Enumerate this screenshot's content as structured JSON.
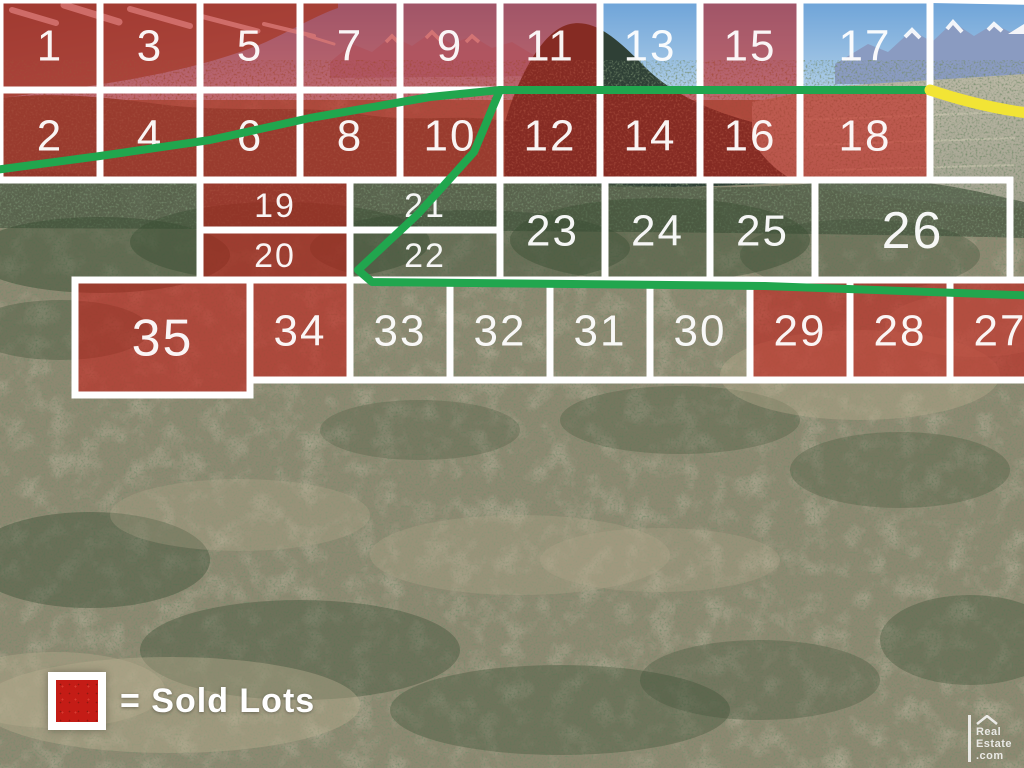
{
  "legend": {
    "label": "= Sold Lots",
    "swatch_meaning": "sold lot"
  },
  "logo": {
    "lines": [
      "Real",
      "Estate",
      ".com"
    ],
    "icon": "roof-icon"
  },
  "colors": {
    "sold_fill": "#c41c16",
    "boundary_white": "#ffffff",
    "trail_green": "#21a64e",
    "boundary_yellow": "#f2e435"
  },
  "plat": {
    "lots": [
      {
        "num": 1,
        "sold": true,
        "x": 0,
        "y": 0,
        "w": 100,
        "h": 90
      },
      {
        "num": 3,
        "sold": true,
        "x": 100,
        "y": 0,
        "w": 100,
        "h": 90
      },
      {
        "num": 5,
        "sold": true,
        "x": 200,
        "y": 0,
        "w": 100,
        "h": 90
      },
      {
        "num": 7,
        "sold": true,
        "x": 300,
        "y": 0,
        "w": 100,
        "h": 90
      },
      {
        "num": 9,
        "sold": true,
        "x": 400,
        "y": 0,
        "w": 100,
        "h": 90
      },
      {
        "num": 11,
        "sold": true,
        "x": 500,
        "y": 0,
        "w": 100,
        "h": 90
      },
      {
        "num": 13,
        "sold": false,
        "x": 600,
        "y": 0,
        "w": 100,
        "h": 90
      },
      {
        "num": 15,
        "sold": true,
        "x": 700,
        "y": 0,
        "w": 100,
        "h": 90
      },
      {
        "num": 17,
        "sold": false,
        "x": 800,
        "y": 0,
        "w": 130,
        "h": 90
      },
      {
        "num": 2,
        "sold": true,
        "x": 0,
        "y": 90,
        "w": 100,
        "h": 90
      },
      {
        "num": 4,
        "sold": true,
        "x": 100,
        "y": 90,
        "w": 100,
        "h": 90
      },
      {
        "num": 6,
        "sold": true,
        "x": 200,
        "y": 90,
        "w": 100,
        "h": 90
      },
      {
        "num": 8,
        "sold": true,
        "x": 300,
        "y": 90,
        "w": 100,
        "h": 90
      },
      {
        "num": 10,
        "sold": true,
        "x": 400,
        "y": 90,
        "w": 100,
        "h": 90
      },
      {
        "num": 12,
        "sold": true,
        "x": 500,
        "y": 90,
        "w": 100,
        "h": 90
      },
      {
        "num": 14,
        "sold": true,
        "x": 600,
        "y": 90,
        "w": 100,
        "h": 90
      },
      {
        "num": 16,
        "sold": true,
        "x": 700,
        "y": 90,
        "w": 100,
        "h": 90
      },
      {
        "num": 18,
        "sold": true,
        "x": 800,
        "y": 90,
        "w": 130,
        "h": 90
      },
      {
        "num": 19,
        "sold": true,
        "x": 200,
        "y": 180,
        "w": 150,
        "h": 50
      },
      {
        "num": 20,
        "sold": true,
        "x": 200,
        "y": 230,
        "w": 150,
        "h": 50
      },
      {
        "num": 21,
        "sold": false,
        "x": 350,
        "y": 180,
        "w": 150,
        "h": 50
      },
      {
        "num": 22,
        "sold": false,
        "x": 350,
        "y": 230,
        "w": 150,
        "h": 50
      },
      {
        "num": 23,
        "sold": false,
        "x": 500,
        "y": 180,
        "w": 105,
        "h": 100
      },
      {
        "num": 24,
        "sold": false,
        "x": 605,
        "y": 180,
        "w": 105,
        "h": 100
      },
      {
        "num": 25,
        "sold": false,
        "x": 710,
        "y": 180,
        "w": 105,
        "h": 100
      },
      {
        "num": 26,
        "sold": false,
        "x": 815,
        "y": 180,
        "w": 195,
        "h": 100
      },
      {
        "num": 35,
        "sold": true,
        "x": 75,
        "y": 280,
        "w": 175,
        "h": 115
      },
      {
        "num": 34,
        "sold": true,
        "x": 250,
        "y": 280,
        "w": 100,
        "h": 100
      },
      {
        "num": 33,
        "sold": false,
        "x": 350,
        "y": 280,
        "w": 100,
        "h": 100
      },
      {
        "num": 32,
        "sold": false,
        "x": 450,
        "y": 280,
        "w": 100,
        "h": 100
      },
      {
        "num": 31,
        "sold": false,
        "x": 550,
        "y": 280,
        "w": 100,
        "h": 100
      },
      {
        "num": 30,
        "sold": false,
        "x": 650,
        "y": 280,
        "w": 100,
        "h": 100
      },
      {
        "num": 29,
        "sold": true,
        "x": 750,
        "y": 280,
        "w": 100,
        "h": 100
      },
      {
        "num": 28,
        "sold": true,
        "x": 850,
        "y": 280,
        "w": 100,
        "h": 100
      },
      {
        "num": 27,
        "sold": true,
        "x": 950,
        "y": 280,
        "w": 100,
        "h": 100
      },
      {
        "num": 41,
        "sold": false,
        "x": 960,
        "y": -190,
        "w": 160,
        "h": 85
      },
      {
        "num": 40,
        "sold": false,
        "x": 1120,
        "y": -190,
        "w": 85,
        "h": 85
      },
      {
        "num": 39,
        "sold": false,
        "x": 1205,
        "y": -190,
        "w": 85,
        "h": 85
      },
      {
        "num": 36,
        "sold": false,
        "x": 960,
        "y": -105,
        "w": 160,
        "h": 85
      },
      {
        "num": 37,
        "sold": false,
        "x": 1120,
        "y": -105,
        "w": 85,
        "h": 85
      },
      {
        "num": 38,
        "sold": false,
        "x": 1205,
        "y": -105,
        "w": 85,
        "h": 85
      }
    ],
    "trails": {
      "green": [
        "M -330,15 C -260,35 -240,55 -205,68 C -165,82 -175,112 -150,132 C -122,152 -85,158 -55,183 L -5,170 L 100,156 L 210,140 L 310,118 L 430,97 L 500,90 L 930,90",
        "M 500,90 L 474,152 L 418,214 L 358,270 L 372,282 L 765,286 L 1070,297"
      ],
      "yellow": "M 930,90 C 990,110 1040,117 1100,118 C 1175,120 1235,104 1270,72 C 1292,52 1298,28 1288,12 C 1280,0 1290,-8 1297,-22 C 1304,-38 1300,-58 1283,-72 C 1260,-90 1195,-99 1120,-104"
    },
    "extensions": [
      "M 930,0 L 1700,14",
      "M 1290,-190 L 1700,-180",
      "M 1050,380 L 1180,560"
    ]
  }
}
